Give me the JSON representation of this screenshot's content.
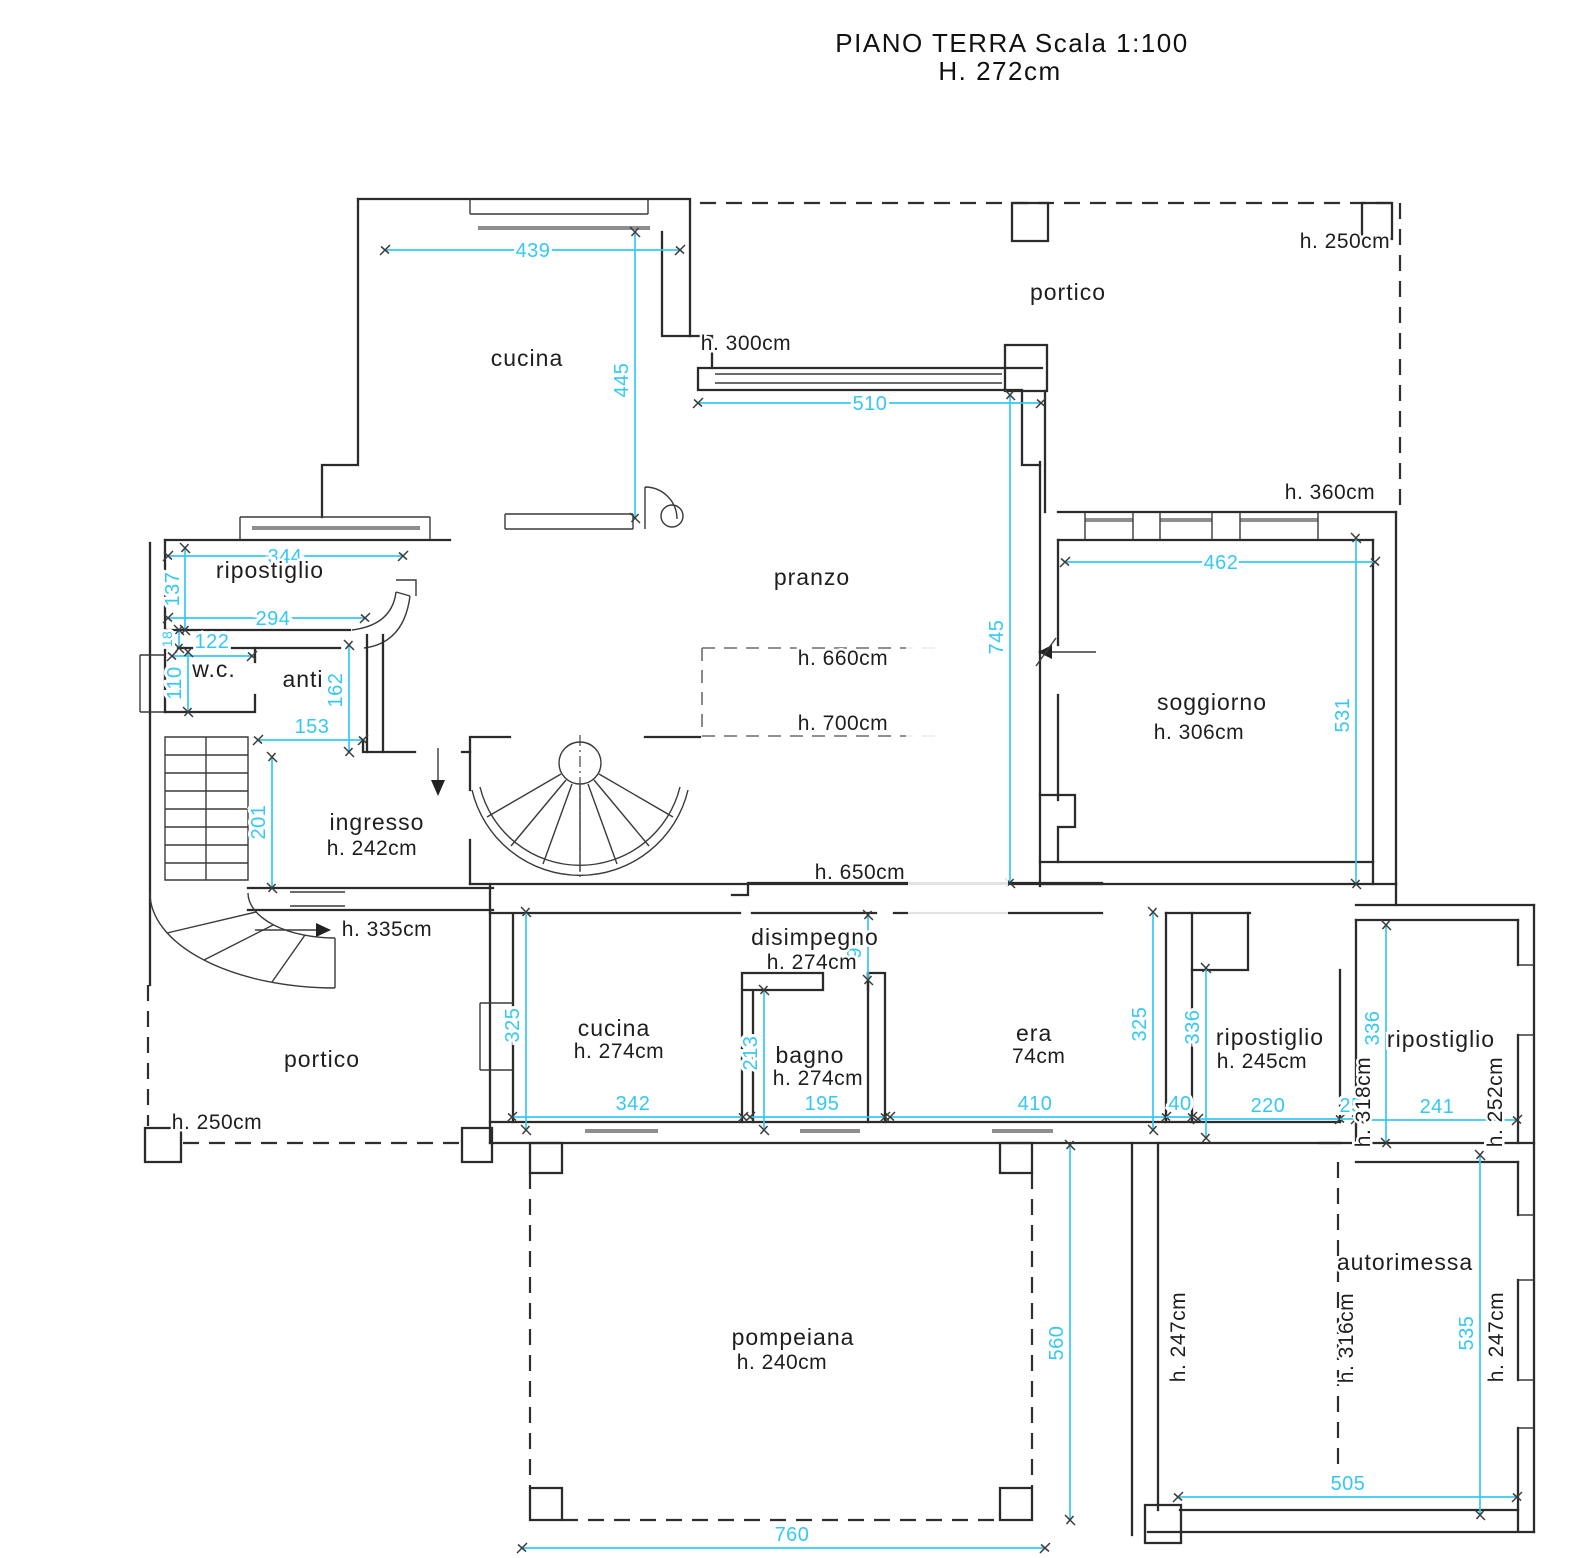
{
  "title": {
    "line1": "PIANO TERRA Scala 1:100",
    "line2": "H. 272cm"
  },
  "colors": {
    "dimension": "#35c8f5",
    "wall": "#2b2b2b",
    "background": "#ffffff"
  },
  "rooms": {
    "cucina_top": {
      "label": "cucina"
    },
    "portico_top": {
      "label": "portico",
      "height": "h. 250cm"
    },
    "ripostiglio_top": {
      "label": "ripostiglio"
    },
    "wc": {
      "label": "w.c."
    },
    "anti": {
      "label": "anti"
    },
    "pranzo": {
      "label": "pranzo"
    },
    "soggiorno": {
      "label": "soggiorno",
      "height": "h. 306cm"
    },
    "ingresso": {
      "label": "ingresso",
      "height": "h. 242cm"
    },
    "disimpegno": {
      "label": "disimpegno",
      "height": "h. 274cm"
    },
    "portico_bottom": {
      "label": "portico",
      "height": "h. 250cm"
    },
    "cucina_bottom": {
      "label": "cucina",
      "height": "h. 274cm"
    },
    "bagno": {
      "label": "bagno",
      "height": "h. 274cm"
    },
    "camera_partial": {
      "label": "era",
      "height": "74cm"
    },
    "ripostiglio_mid": {
      "label": "ripostiglio",
      "height": "h. 245cm"
    },
    "ripostiglio_right": {
      "label": "ripostiglio",
      "height_left": "h. 318cm",
      "height_right": "h. 252cm"
    },
    "autorimessa": {
      "label": "autorimessa",
      "height_left": "h. 247cm",
      "height_mid": "h. 316cm",
      "height_right": "h. 247cm"
    },
    "pompeiana": {
      "label": "pompeiana",
      "height": "h. 240cm"
    }
  },
  "heights": {
    "h300": "h. 300cm",
    "h360": "h. 360cm",
    "h660": "h. 660cm",
    "h700": "h. 700cm",
    "h650": "h. 650cm",
    "h335": "h. 335cm"
  },
  "dims": {
    "d439": "439",
    "d445": "445",
    "d510": "510",
    "d344": "344",
    "d137": "137",
    "d294": "294",
    "d122": "122",
    "d110": "110",
    "d18": "18",
    "d162": "162",
    "d153": "153",
    "d201": "201",
    "d745": "745",
    "d462": "462",
    "d531": "531",
    "d97": "97",
    "d325L": "325",
    "d342": "342",
    "d213": "213",
    "d195": "195",
    "d410": "410",
    "d325R": "325",
    "d40": "40",
    "d336M": "336",
    "d220": "220",
    "d25": "25",
    "d336R": "336",
    "d241": "241",
    "d505": "505",
    "d535": "535",
    "d560": "560",
    "d760": "760"
  }
}
